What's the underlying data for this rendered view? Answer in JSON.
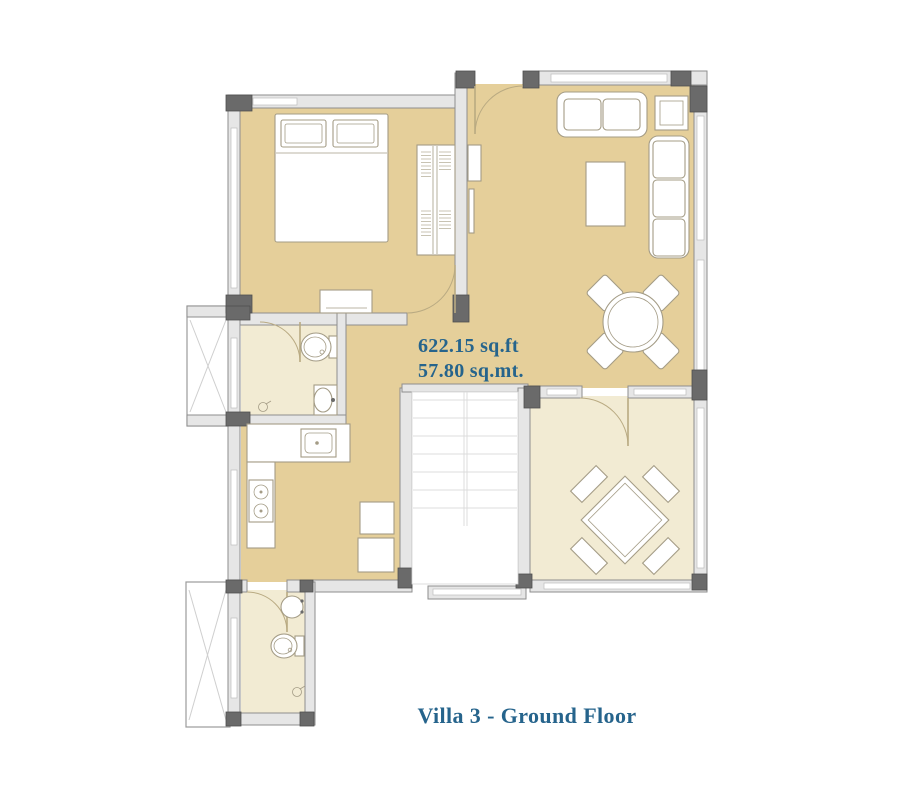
{
  "plan": {
    "area_sqft": "622.15 sq.ft",
    "area_sqmt": "57.80 sq.mt.",
    "title": "Villa 3 - Ground Floor",
    "colors": {
      "background": "#ffffff",
      "floor_main": "#e5cf9a",
      "floor_light": "#f2ebd3",
      "wall_fill": "#e6e6e6",
      "wall_stroke": "#8e8e8e",
      "column_fill": "#6a6a6a",
      "window_fill": "#ffffff",
      "furniture_stroke": "#a49c86",
      "label_blue": "#26648c"
    }
  }
}
